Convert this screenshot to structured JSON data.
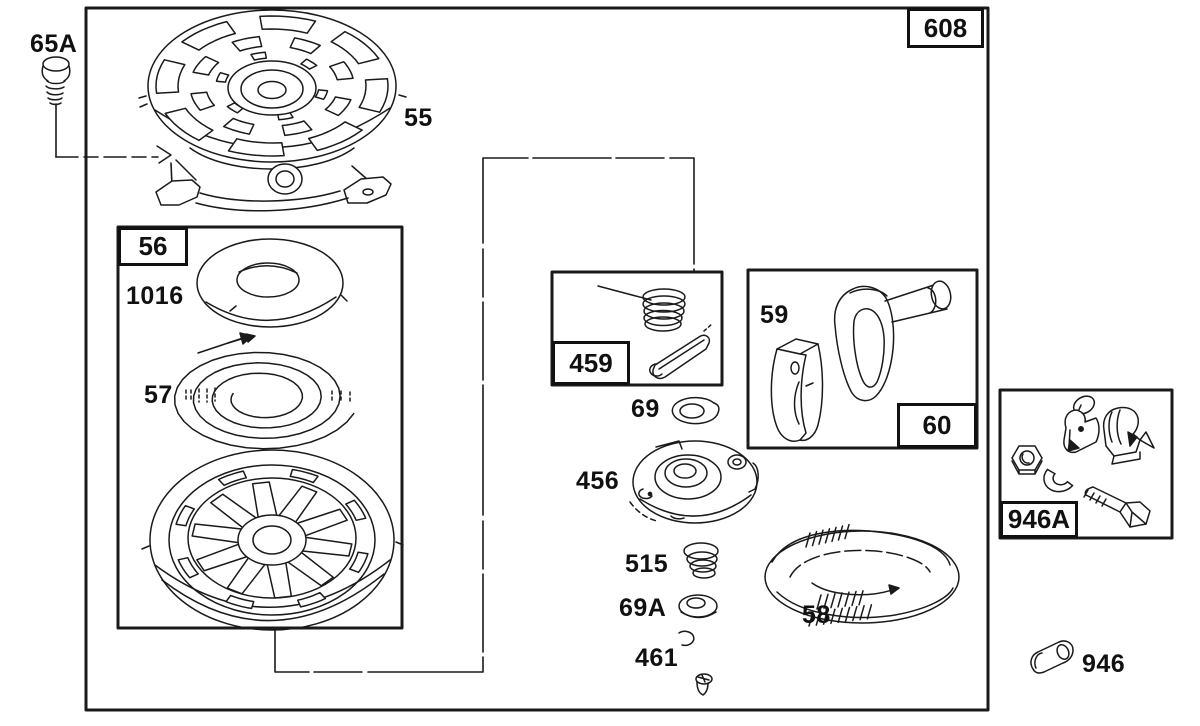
{
  "figure": {
    "type": "exploded-parts-diagram",
    "subject": "rewind starter assembly",
    "assembly_label": "608",
    "groups": {
      "spring_housing_box": "56",
      "pawl_kit_box": "459",
      "handle_kit_box": "60",
      "bracket_kit_box": "946A"
    },
    "parts": {
      "screw": "65A",
      "housing": "55",
      "washer_plate": "1016",
      "rewind_spring": "57",
      "thrust_washer": "69",
      "handle_insert": "59",
      "pulley": "456",
      "clutch_spring": "515",
      "thrust_washer_a": "69A",
      "retainer_screw": "461",
      "starter_rope": "58",
      "clamp": "946"
    },
    "colors": {
      "line": "#1a1a1a",
      "background": "#ffffff"
    }
  }
}
